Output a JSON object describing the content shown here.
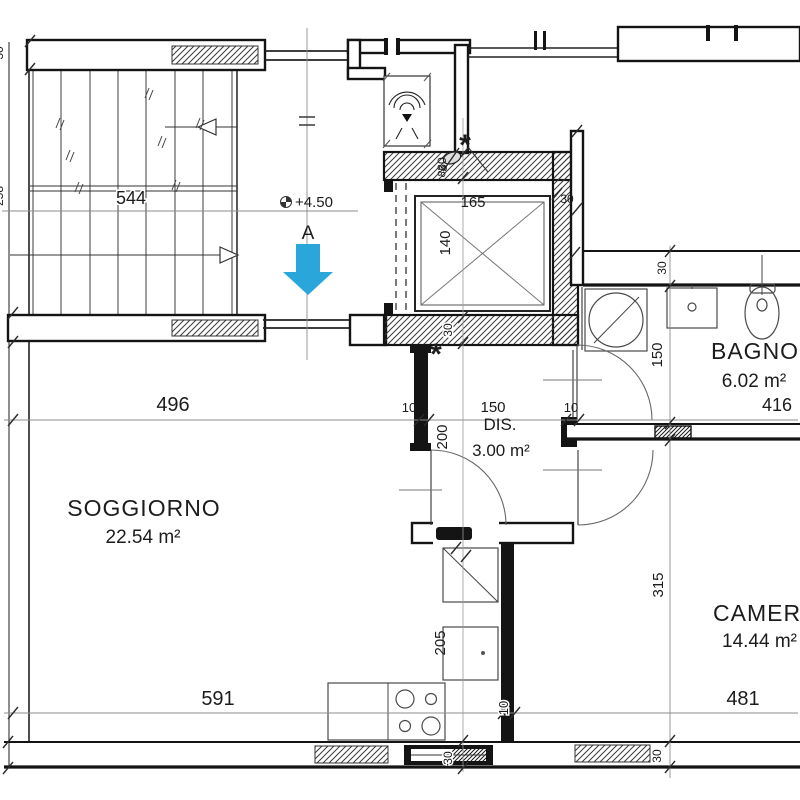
{
  "rooms": {
    "soggiorno": {
      "name": "SOGGIORNO",
      "area": "22.54 m²"
    },
    "dis": {
      "name": "DIS.",
      "area": "3.00 m²"
    },
    "bagno": {
      "name": "BAGNO",
      "area": "6.02 m²"
    },
    "camera": {
      "name": "CAMERA",
      "area": "14.44 m²"
    }
  },
  "annotations": {
    "level": "+4.50",
    "section_label": "A",
    "asterisk": "*",
    "door_width_mark": "85"
  },
  "dims": {
    "stair_flight": "544",
    "soggiorno_width": "496",
    "soggiorno_bottom": "591",
    "camera_bottom": "481",
    "bagno_width": "416",
    "dis_width": "150",
    "dis_depth": "200",
    "kitchen_depth": "205",
    "camera_depth": "315",
    "bagno_depth": "150",
    "lift_width": "165",
    "lift_depth": "140",
    "wall_thin": "10",
    "wall_thick": "30",
    "edge_top": "30",
    "edge_mid": "258"
  },
  "colors": {
    "arrow": "#2aa6db"
  }
}
